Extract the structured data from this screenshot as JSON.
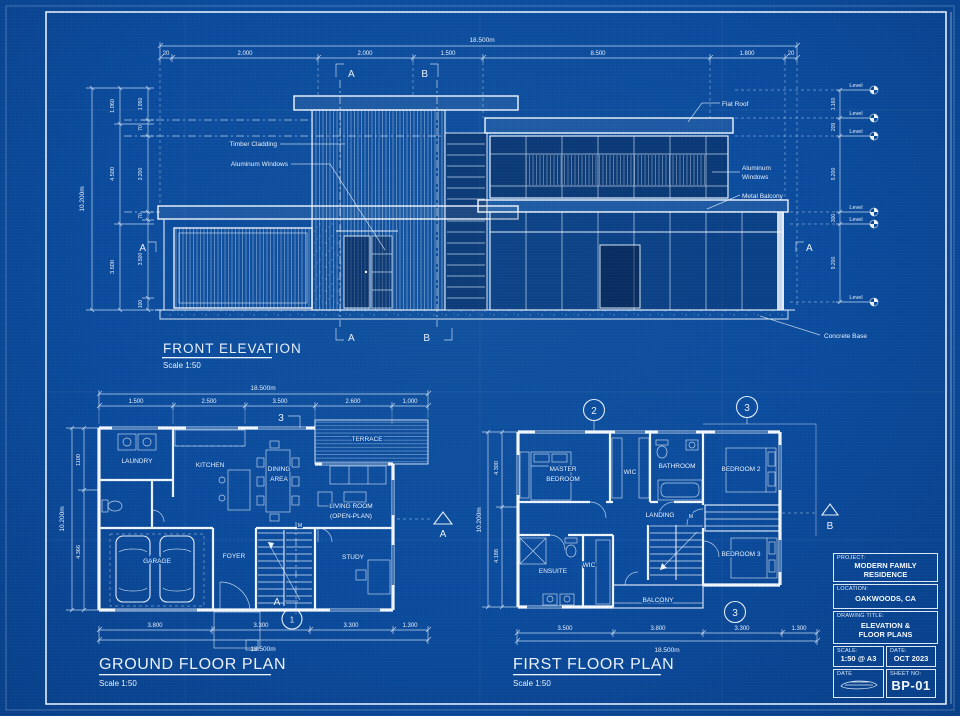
{
  "elevation": {
    "title": "FRONT ELEVATION",
    "scale": "Scale 1:50",
    "dims": {
      "total": "18.500m",
      "top": [
        "20",
        "2.000",
        "2.000",
        "1.500",
        "8.500",
        "1.800",
        "20"
      ],
      "left_total": "10.200m",
      "left_outer": [
        "1.060",
        "4.500",
        "3.600"
      ],
      "left_inner": [
        "1.950",
        "70",
        "3.200",
        "70",
        "3.500",
        "100"
      ],
      "right": [
        "1.160",
        "209",
        "5.200",
        "300",
        "9.200"
      ]
    },
    "level_label": "Level",
    "callouts": {
      "flat_roof": "Flat Roof",
      "timber_cladding": "Timber Cladding",
      "aluminum_windows": "Aluminum Windows",
      "aluminum_2a": "Aluminum",
      "aluminum_2b": "Windows",
      "metal_balcony": "Metal Balcony",
      "concrete_base": "Concrete Base"
    },
    "sections": {
      "a": "A",
      "b": "B"
    }
  },
  "ground_floor": {
    "title": "GROUND FLOOR PLAN",
    "scale": "Scale 1:50",
    "dims": {
      "total": "18.500m",
      "top": [
        "1.500",
        "2.500",
        "3.500",
        "2.600",
        "1.000"
      ],
      "bottom": [
        "3.800",
        "3.300",
        "3.300",
        "1.300"
      ],
      "left_total": "10.200m",
      "left": [
        "1100",
        "4.366"
      ]
    },
    "rooms": {
      "laundry": "LAUNDRY",
      "kitchen": "KITCHEN",
      "dining1": "DINING",
      "dining2": "AREA",
      "terrace": "TERRACE",
      "living1": "LIVING ROOM",
      "living2": "(OPEN-PLAN)",
      "garage": "GARAGE",
      "foyer": "FOYER",
      "study": "STUDY"
    },
    "markers": {
      "grid3": "3",
      "section_a": "A",
      "circle1": "1",
      "side_a": "A",
      "m": "M"
    }
  },
  "first_floor": {
    "title": "FIRST FLOOR PLAN",
    "scale": "Scale 1:50",
    "dims": {
      "total": "18.500m",
      "bottom": [
        "3.500",
        "3.800",
        "3.300",
        "1.300"
      ],
      "left_total": "10.200m",
      "left": [
        "4.300",
        "4.188"
      ]
    },
    "rooms": {
      "master1": "MASTER",
      "master2": "BEDROOM",
      "wic": "WIC",
      "bathroom": "BATHROOM",
      "bedroom2": "BEDROOM 2",
      "landing": "LANDING",
      "ensuite": "ENSUITE",
      "wic2": "WIC",
      "balcony": "BALCONY",
      "bedroom3": "BEDROOM 3"
    },
    "markers": {
      "grid2": "2",
      "grid3": "3",
      "circle3": "3",
      "side_b": "B",
      "m": "M"
    }
  },
  "title_block": {
    "project_label": "PROJECT:",
    "project1": "MODERN FAMILY",
    "project2": "RESIDENCE",
    "location_label": "LOCATION:",
    "location": "OAKWOODS, CA",
    "drawing_title_label": "DRAWING TITLE:",
    "drawing_title1": "ELEVATION &",
    "drawing_title2": "FLOOR PLANS",
    "scale_label": "SCALE:",
    "scale": "1:50 @ A3",
    "date_label": "DATE:",
    "date": "OCT 2023",
    "date2_label": "DATE",
    "sheet_label": "SHEET NO:",
    "sheet": "BP-01"
  }
}
